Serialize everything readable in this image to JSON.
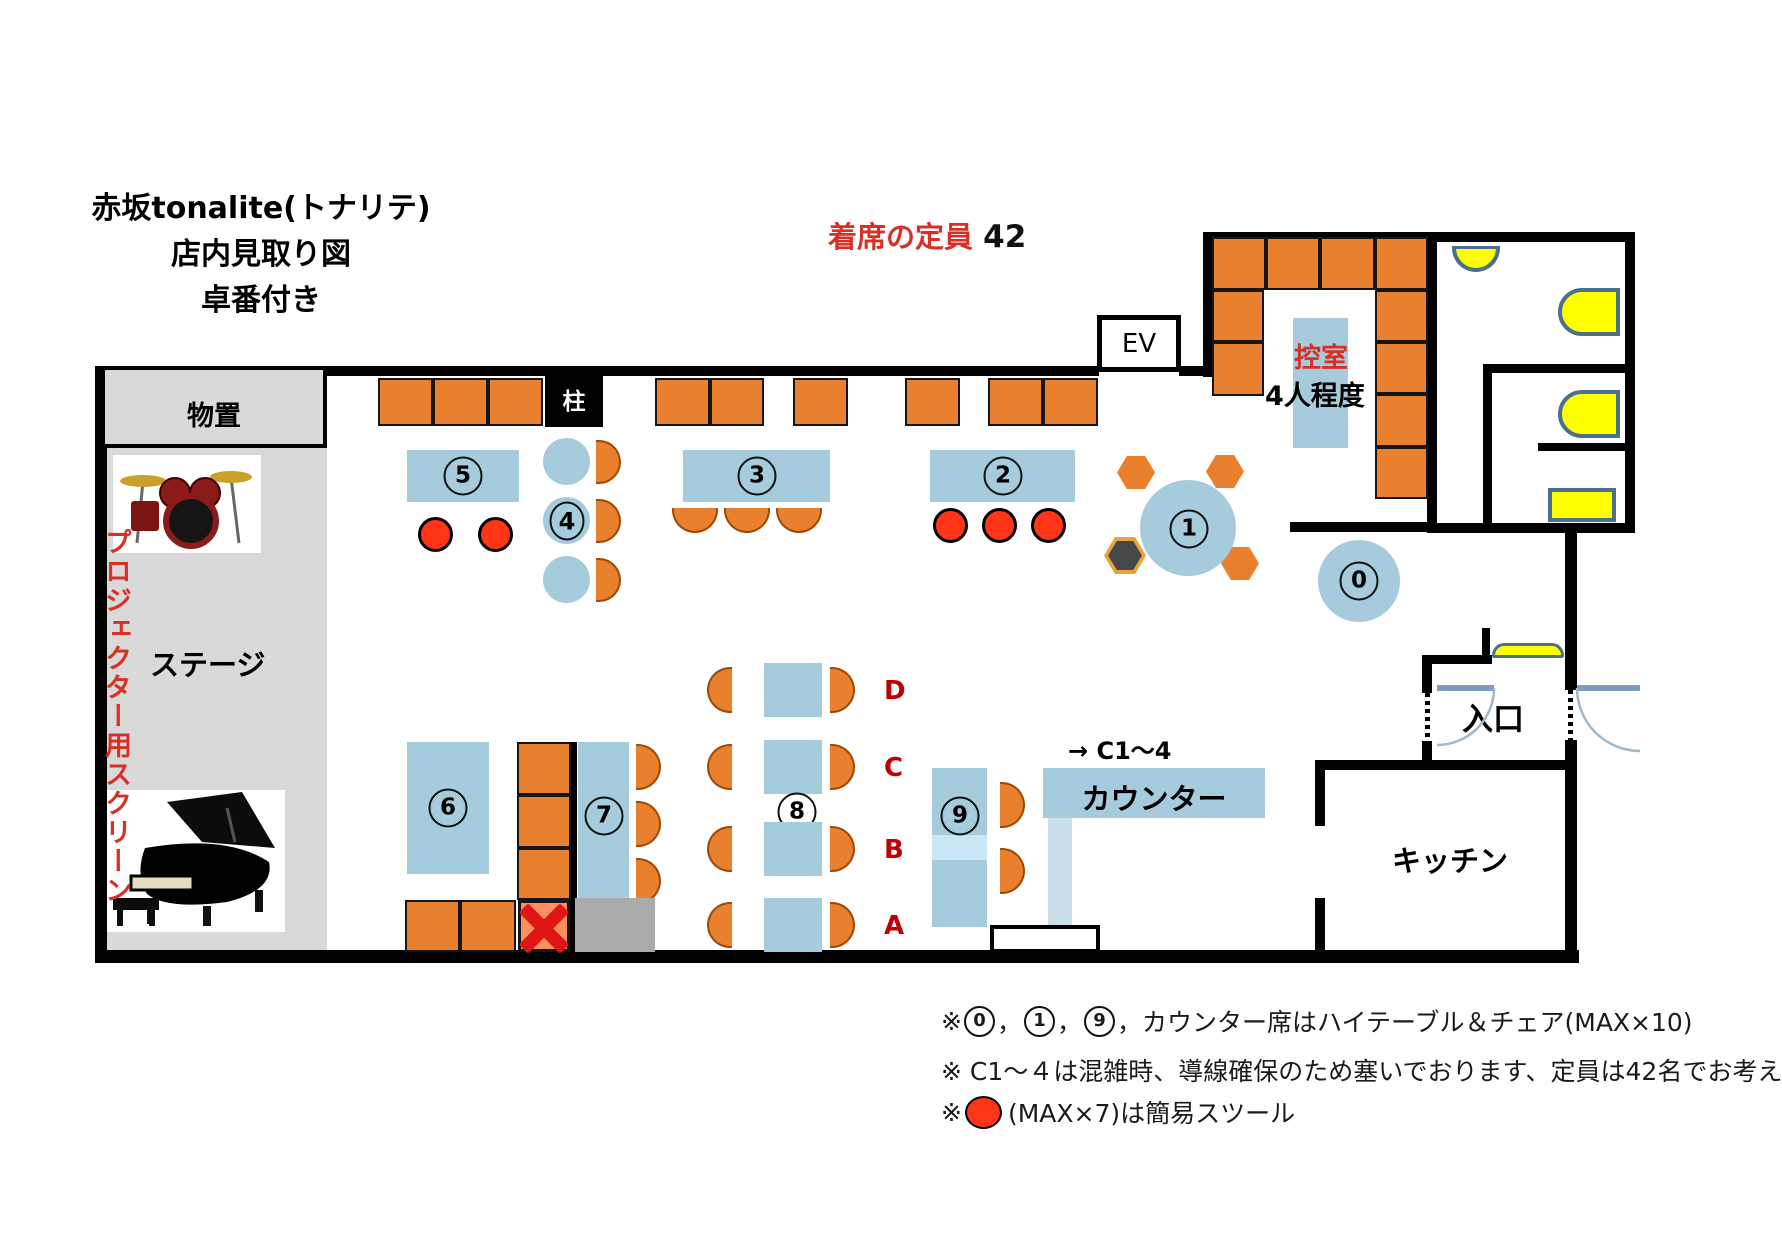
{
  "title": {
    "line1": "赤坂tonalite(トナリテ)",
    "line2": "店内見取り図",
    "line3": "卓番付き"
  },
  "capacity": {
    "label": "着席の定員",
    "value": "42"
  },
  "rooms": {
    "storage": "物置",
    "stage": "ステージ",
    "projector_screen": "プロジェクター用スクリーン",
    "elevator": "EV",
    "pillar": "柱",
    "waiting_room": {
      "name": "控室",
      "capacity": "4人程度"
    },
    "entrance": "入口",
    "kitchen": "キッチン",
    "counter": "カウンター",
    "counter_arrow_note": "→ C1～4"
  },
  "tables": {
    "t0": "0",
    "t1": "1",
    "t2": "2",
    "t3": "3",
    "t4": "4",
    "t5": "5",
    "t6": "6",
    "t7": "7",
    "t8": "8",
    "t9": "9",
    "rows": {
      "d": "D",
      "c": "C",
      "b": "B",
      "a": "A"
    }
  },
  "notes": {
    "n1_pre": "※",
    "n1_num1": "0",
    "n1_sep1": "，",
    "n1_num2": "1",
    "n1_sep2": "，",
    "n1_num3": "9",
    "n1_sep3": "，",
    "n1_tail": "カウンター席はハイテーブル＆チェア(MAX×10)",
    "n2": "※ C1～４は混雑時、導線確保のため塞いでおります、定員は42名でお考え下さい。",
    "n3_pre": "※",
    "n3_tail": "(MAX×7)は簡易スツール"
  },
  "colors": {
    "seat_orange": "#E8802E",
    "table_blue": "#A5CBDC",
    "stool_red": "#FF3517",
    "accent_red": "#D93025",
    "fixture_yellow": "#FFFF00",
    "stage_gray": "#D9D9D9"
  }
}
